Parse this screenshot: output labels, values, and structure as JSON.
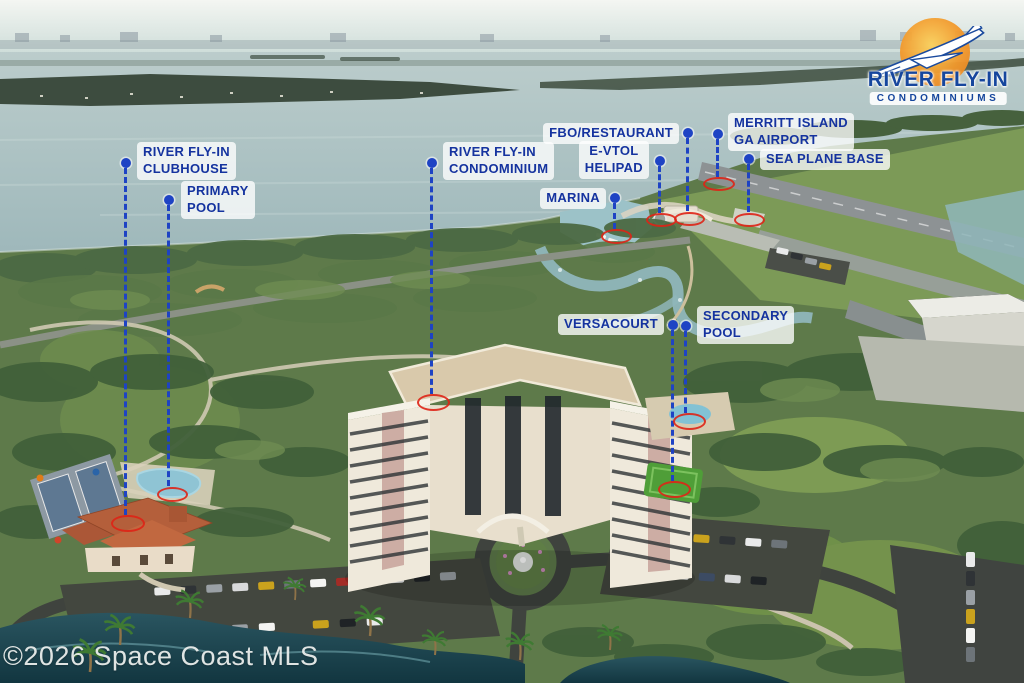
{
  "logo": {
    "title": "RIVER FLY-IN",
    "subtitle": "CONDOMINIUMS"
  },
  "watermark": "©2026 Space Coast MLS",
  "callouts": {
    "clubhouse": "RIVER FLY-IN\nCLUBHOUSE",
    "primary_pool": "PRIMARY\nPOOL",
    "condominium": "RIVER FLY-IN\nCONDOMINIUM",
    "marina": "MARINA",
    "fbo_restaurant": "FBO/RESTAURANT",
    "evtol_helipad": "E-VTOL\nHELIPAD",
    "ga_airport": "MERRITT ISLAND\nGA AIRPORT",
    "sea_plane_base": "SEA PLANE BASE",
    "versacourt": "VERSACOURT",
    "secondary_pool": "SECONDARY\nPOOL"
  },
  "colors": {
    "callout_blue": "#1e43c4",
    "callout_text": "#15339f",
    "target_red": "#de2416",
    "logo_blue": "#16469d",
    "logo_orange": "#f2992c"
  }
}
